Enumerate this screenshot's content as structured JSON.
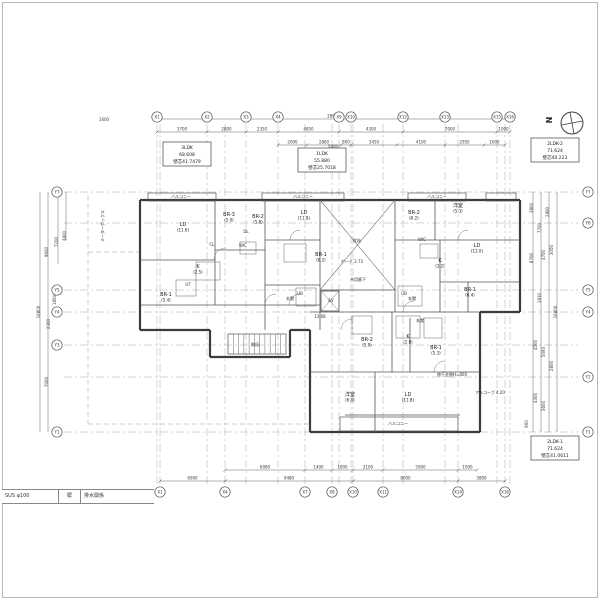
{
  "meta": {
    "drawing_type": "apartment-floor-plan",
    "bg": "#ffffff",
    "wall_color": "#3c3c3c",
    "inner_color": "#555555",
    "dim_color": "#3a3a3a",
    "grid_color": "#a8a8a8"
  },
  "north": {
    "label": "N"
  },
  "title_strip": {
    "cells": [
      "SUS φ100",
      "塀",
      "排水関係"
    ]
  },
  "unit_boxes": [
    {
      "x": 163,
      "y": 142,
      "w": 48,
      "h": 24,
      "lines": [
        "3LDK",
        "68.608",
        "壁芯41.7479"
      ]
    },
    {
      "x": 298,
      "y": 148,
      "w": 48,
      "h": 24,
      "lines": [
        "1LDK",
        "55.880",
        "壁芯25.7018"
      ]
    },
    {
      "x": 531,
      "y": 138,
      "w": 48,
      "h": 24,
      "lines": [
        "2LDK-2",
        "71.624",
        "壁芯40.223"
      ]
    },
    {
      "x": 531,
      "y": 436,
      "w": 48,
      "h": 24,
      "lines": [
        "2LDK-1",
        "71.624",
        "壁芯41.0611"
      ]
    }
  ],
  "axes": {
    "top_y": 117,
    "bottom_y": 492,
    "left_x": 57,
    "right_x": 588,
    "top": [
      {
        "label": "X1",
        "x": 157
      },
      {
        "label": "X2",
        "x": 207
      },
      {
        "label": "X3",
        "x": 246
      },
      {
        "label": "X4",
        "x": 278
      },
      {
        "label": "X9",
        "x": 339
      },
      {
        "label": "X10",
        "x": 351
      },
      {
        "label": "X12",
        "x": 403
      },
      {
        "label": "X13",
        "x": 445
      },
      {
        "label": "X15",
        "x": 497
      },
      {
        "label": "X16",
        "x": 510
      }
    ],
    "bottom": [
      {
        "label": "X1",
        "x": 160
      },
      {
        "label": "X4",
        "x": 225
      },
      {
        "label": "X7",
        "x": 305
      },
      {
        "label": "X8",
        "x": 332
      },
      {
        "label": "X10",
        "x": 353
      },
      {
        "label": "X11",
        "x": 383
      },
      {
        "label": "X14",
        "x": 458
      },
      {
        "label": "X16",
        "x": 505
      }
    ],
    "left": [
      {
        "label": "Y7",
        "y": 192
      },
      {
        "label": "Y5",
        "y": 290
      },
      {
        "label": "Y4",
        "y": 312
      },
      {
        "label": "Y3",
        "y": 345
      },
      {
        "label": "Y1",
        "y": 432
      }
    ],
    "right": [
      {
        "label": "Y7",
        "y": 192
      },
      {
        "label": "Y6",
        "y": 223
      },
      {
        "label": "Y5",
        "y": 290
      },
      {
        "label": "Y4",
        "y": 312
      },
      {
        "label": "Y2",
        "y": 377
      },
      {
        "label": "Y1",
        "y": 432
      }
    ]
  },
  "dims": {
    "top_rows": [
      {
        "y": 119,
        "segs": [
          {
            "x1": 157,
            "x2": 510,
            "t": "28800"
          }
        ]
      },
      {
        "y": 132,
        "segs": [
          {
            "x1": 157,
            "x2": 207,
            "t": "3700"
          },
          {
            "x1": 207,
            "x2": 246,
            "t": "2800"
          },
          {
            "x1": 246,
            "x2": 278,
            "t": "2350"
          },
          {
            "x1": 278,
            "x2": 339,
            "t": "4850"
          },
          {
            "x1": 339,
            "x2": 403,
            "t": "4300"
          },
          {
            "x1": 403,
            "x2": 497,
            "t": "7000"
          },
          {
            "x1": 497,
            "x2": 510,
            "t": "1000"
          }
        ]
      },
      {
        "y": 145,
        "segs": [
          {
            "x1": 278,
            "x2": 307,
            "t": "2000"
          },
          {
            "x1": 307,
            "x2": 341,
            "t": "2860"
          },
          {
            "x1": 341,
            "x2": 351,
            "t": "800"
          },
          {
            "x1": 351,
            "x2": 397,
            "t": "3450"
          },
          {
            "x1": 397,
            "x2": 445,
            "t": "4100"
          },
          {
            "x1": 445,
            "x2": 484,
            "t": "2950"
          },
          {
            "x1": 484,
            "x2": 505,
            "t": "1600"
          }
        ]
      }
    ],
    "bottom_rows": [
      {
        "y": 470,
        "segs": [
          {
            "x1": 225,
            "x2": 305,
            "t": "6080"
          },
          {
            "x1": 305,
            "x2": 332,
            "t": "1400"
          },
          {
            "x1": 332,
            "x2": 353,
            "t": "1800"
          },
          {
            "x1": 353,
            "x2": 383,
            "t": "2100"
          },
          {
            "x1": 383,
            "x2": 458,
            "t": "5900"
          },
          {
            "x1": 458,
            "x2": 477,
            "t": "1000"
          }
        ]
      },
      {
        "y": 481,
        "segs": [
          {
            "x1": 160,
            "x2": 225,
            "t": "6900"
          },
          {
            "x1": 225,
            "x2": 353,
            "t": "9480"
          },
          {
            "x1": 353,
            "x2": 458,
            "t": "8000"
          },
          {
            "x1": 458,
            "x2": 505,
            "t": "3800"
          }
        ]
      }
    ],
    "left_labels": [
      {
        "x": 48,
        "y": 252,
        "t": "9600"
      },
      {
        "x": 58,
        "y": 242,
        "t": "7200"
      },
      {
        "x": 66,
        "y": 236,
        "t": "4800"
      },
      {
        "x": 56,
        "y": 300,
        "t": "1800"
      },
      {
        "x": 50,
        "y": 324,
        "t": "2300"
      },
      {
        "x": 48,
        "y": 382,
        "t": "7000"
      },
      {
        "x": 40,
        "y": 312,
        "t": "16800"
      }
    ],
    "left_lines": [
      {
        "x": 40,
        "y1": 192,
        "y2": 432
      },
      {
        "x": 48,
        "y1": 192,
        "y2": 432
      },
      {
        "x": 58,
        "y1": 192,
        "y2": 264
      },
      {
        "x": 66,
        "y1": 192,
        "y2": 240
      }
    ],
    "right_labels": [
      {
        "x": 533,
        "y": 208,
        "t": "3800"
      },
      {
        "x": 541,
        "y": 228,
        "t": "7700"
      },
      {
        "x": 549,
        "y": 212,
        "t": "2800"
      },
      {
        "x": 533,
        "y": 258,
        "t": "8700"
      },
      {
        "x": 545,
        "y": 255,
        "t": "4700"
      },
      {
        "x": 553,
        "y": 250,
        "t": "3050"
      },
      {
        "x": 541,
        "y": 298,
        "t": "1830"
      },
      {
        "x": 557,
        "y": 312,
        "t": "16800"
      },
      {
        "x": 537,
        "y": 345,
        "t": "4500"
      },
      {
        "x": 545,
        "y": 352,
        "t": "5093"
      },
      {
        "x": 553,
        "y": 366,
        "t": "2800"
      },
      {
        "x": 537,
        "y": 398,
        "t": "4300"
      },
      {
        "x": 545,
        "y": 406,
        "t": "3600"
      },
      {
        "x": 528,
        "y": 424,
        "t": "900"
      }
    ],
    "right_lines": [
      {
        "x": 533,
        "y1": 192,
        "y2": 432
      },
      {
        "x": 541,
        "y1": 192,
        "y2": 432
      },
      {
        "x": 549,
        "y1": 192,
        "y2": 432
      },
      {
        "x": 557,
        "y1": 192,
        "y2": 432
      }
    ],
    "extra_texts": [
      {
        "x": 333,
        "y": 148,
        "t": "5000"
      },
      {
        "x": 104,
        "y": 121,
        "t": "1600"
      }
    ]
  },
  "plan": {
    "outer_walls": [
      [
        140,
        200,
        520,
        200
      ],
      [
        520,
        200,
        520,
        312
      ],
      [
        520,
        312,
        480,
        312
      ],
      [
        480,
        312,
        480,
        432
      ],
      [
        480,
        432,
        310,
        432
      ],
      [
        310,
        432,
        310,
        330
      ],
      [
        310,
        330,
        290,
        330
      ],
      [
        290,
        330,
        290,
        357
      ],
      [
        290,
        357,
        210,
        357
      ],
      [
        210,
        357,
        210,
        330
      ],
      [
        210,
        330,
        140,
        330
      ],
      [
        140,
        330,
        140,
        200
      ]
    ],
    "inner_walls": [
      [
        215,
        200,
        215,
        305
      ],
      [
        265,
        200,
        265,
        330
      ],
      [
        320,
        200,
        320,
        330
      ],
      [
        395,
        200,
        395,
        312
      ],
      [
        435,
        200,
        435,
        240
      ],
      [
        440,
        240,
        440,
        312
      ],
      [
        468,
        282,
        468,
        312
      ],
      [
        392,
        312,
        392,
        372
      ],
      [
        375,
        372,
        375,
        432
      ],
      [
        410,
        318,
        410,
        372
      ],
      [
        140,
        260,
        215,
        260
      ],
      [
        215,
        250,
        265,
        250
      ],
      [
        140,
        305,
        320,
        305
      ],
      [
        265,
        240,
        320,
        240
      ],
      [
        265,
        285,
        320,
        285
      ],
      [
        395,
        240,
        520,
        240
      ],
      [
        440,
        282,
        520,
        282
      ],
      [
        310,
        312,
        480,
        312
      ],
      [
        320,
        290,
        395,
        290
      ],
      [
        310,
        372,
        480,
        372
      ],
      [
        345,
        415,
        460,
        415
      ]
    ],
    "balconies": [
      {
        "x": 148,
        "y": 193,
        "w": 68,
        "h": 8
      },
      {
        "x": 262,
        "y": 193,
        "w": 82,
        "h": 8
      },
      {
        "x": 408,
        "y": 193,
        "w": 58,
        "h": 8
      },
      {
        "x": 486,
        "y": 193,
        "w": 30,
        "h": 8
      },
      {
        "x": 340,
        "y": 417,
        "w": 118,
        "h": 14
      }
    ],
    "fixtures": [
      {
        "x": 196,
        "y": 262,
        "w": 24,
        "h": 18
      },
      {
        "x": 176,
        "y": 280,
        "w": 20,
        "h": 16
      },
      {
        "x": 240,
        "y": 242,
        "w": 16,
        "h": 12
      },
      {
        "x": 284,
        "y": 244,
        "w": 22,
        "h": 18
      },
      {
        "x": 296,
        "y": 288,
        "w": 20,
        "h": 18
      },
      {
        "x": 398,
        "y": 286,
        "w": 24,
        "h": 20
      },
      {
        "x": 420,
        "y": 244,
        "w": 18,
        "h": 14
      },
      {
        "x": 352,
        "y": 316,
        "w": 20,
        "h": 18
      },
      {
        "x": 396,
        "y": 316,
        "w": 24,
        "h": 22
      },
      {
        "x": 424,
        "y": 318,
        "w": 18,
        "h": 20
      }
    ],
    "void_x": {
      "x1": 320,
      "y1": 200,
      "x2": 395,
      "y2": 290
    },
    "stairs": {
      "x": 228,
      "y": 334,
      "w": 58,
      "h": 20,
      "steps": 11
    },
    "elevator": {
      "x": 321,
      "y": 291,
      "w": 18,
      "h": 20
    },
    "arcs": [
      {
        "x": 226,
        "y": 260,
        "r": 12
      },
      {
        "x": 276,
        "y": 305,
        "r": 11
      },
      {
        "x": 300,
        "y": 305,
        "r": 11
      },
      {
        "x": 352,
        "y": 330,
        "r": 11
      },
      {
        "x": 414,
        "y": 312,
        "r": 11
      },
      {
        "x": 300,
        "y": 240,
        "r": 10
      },
      {
        "x": 445,
        "y": 372,
        "r": 11
      },
      {
        "x": 468,
        "y": 240,
        "r": 10
      }
    ],
    "dashed_lines": [
      [
        88,
        196,
        88,
        424
      ],
      [
        88,
        424,
        310,
        424
      ],
      [
        88,
        252,
        140,
        252
      ]
    ]
  },
  "rooms": [
    {
      "t": "LD",
      "s": "(11.6)",
      "x": 183,
      "y": 226
    },
    {
      "t": "BR-3",
      "s": "(5.0)",
      "x": 229,
      "y": 216
    },
    {
      "t": "BR-2",
      "s": "(5.8)",
      "x": 258,
      "y": 218
    },
    {
      "t": "BR-1",
      "s": "(5.4)",
      "x": 166,
      "y": 296
    },
    {
      "t": "K",
      "s": "(2.5)",
      "x": 198,
      "y": 268
    },
    {
      "t": "LD",
      "s": "(11.8)",
      "x": 304,
      "y": 214
    },
    {
      "t": "BR-1",
      "s": "(6.2)",
      "x": 321,
      "y": 256
    },
    {
      "t": "BR-2",
      "s": "(6.2)",
      "x": 414,
      "y": 214
    },
    {
      "t": "洋室",
      "s": "(5.3)",
      "x": 458,
      "y": 207
    },
    {
      "t": "LD",
      "s": "(12.0)",
      "x": 477,
      "y": 247
    },
    {
      "t": "BR-1",
      "s": "(6.4)",
      "x": 470,
      "y": 291
    },
    {
      "t": "K",
      "s": "(3.2)",
      "x": 440,
      "y": 262
    },
    {
      "t": "BR-2",
      "s": "(5.9)",
      "x": 367,
      "y": 341
    },
    {
      "t": "BR-1",
      "s": "(5.3)",
      "x": 436,
      "y": 349
    },
    {
      "t": "K",
      "s": "(2.8)",
      "x": 408,
      "y": 338
    },
    {
      "t": "洋室",
      "s": "(6.0)",
      "x": 350,
      "y": 396
    },
    {
      "t": "LD",
      "s": "(11.8)",
      "x": 408,
      "y": 396
    }
  ],
  "annotations": [
    {
      "t": "バルコニー",
      "x": 181,
      "y": 198
    },
    {
      "t": "バルコニー",
      "x": 303,
      "y": 198
    },
    {
      "t": "バルコニー",
      "x": 437,
      "y": 198
    },
    {
      "t": "バルコニー",
      "x": 398,
      "y": 425
    },
    {
      "t": "共用廊下",
      "x": 358,
      "y": 281
    },
    {
      "t": "吹抜",
      "x": 357,
      "y": 242
    },
    {
      "t": "EV",
      "x": 331,
      "y": 302
    },
    {
      "t": "階段",
      "x": 255,
      "y": 346
    },
    {
      "t": "玄関",
      "x": 290,
      "y": 300
    },
    {
      "t": "玄関",
      "x": 412,
      "y": 300
    },
    {
      "t": "玄関",
      "x": 420,
      "y": 322
    },
    {
      "t": "WIC",
      "x": 243,
      "y": 247
    },
    {
      "t": "WIC",
      "x": 422,
      "y": 241
    },
    {
      "t": "UT",
      "x": 188,
      "y": 286
    },
    {
      "t": "UB",
      "x": 300,
      "y": 295
    },
    {
      "t": "UB",
      "x": 404,
      "y": 295
    },
    {
      "t": "ポーチ 2.73",
      "x": 352,
      "y": 263
    },
    {
      "t": "アルコーブ 4.20",
      "x": 490,
      "y": 394
    },
    {
      "t": "13.08",
      "x": 320,
      "y": 318
    },
    {
      "t": "物干金物H=800",
      "x": 452,
      "y": 376
    },
    {
      "t": "DL",
      "x": 246,
      "y": 233
    },
    {
      "t": "CL",
      "x": 212,
      "y": 246
    },
    {
      "t": "メーターボックス",
      "x": 104,
      "y": 226,
      "rot": -90
    }
  ]
}
